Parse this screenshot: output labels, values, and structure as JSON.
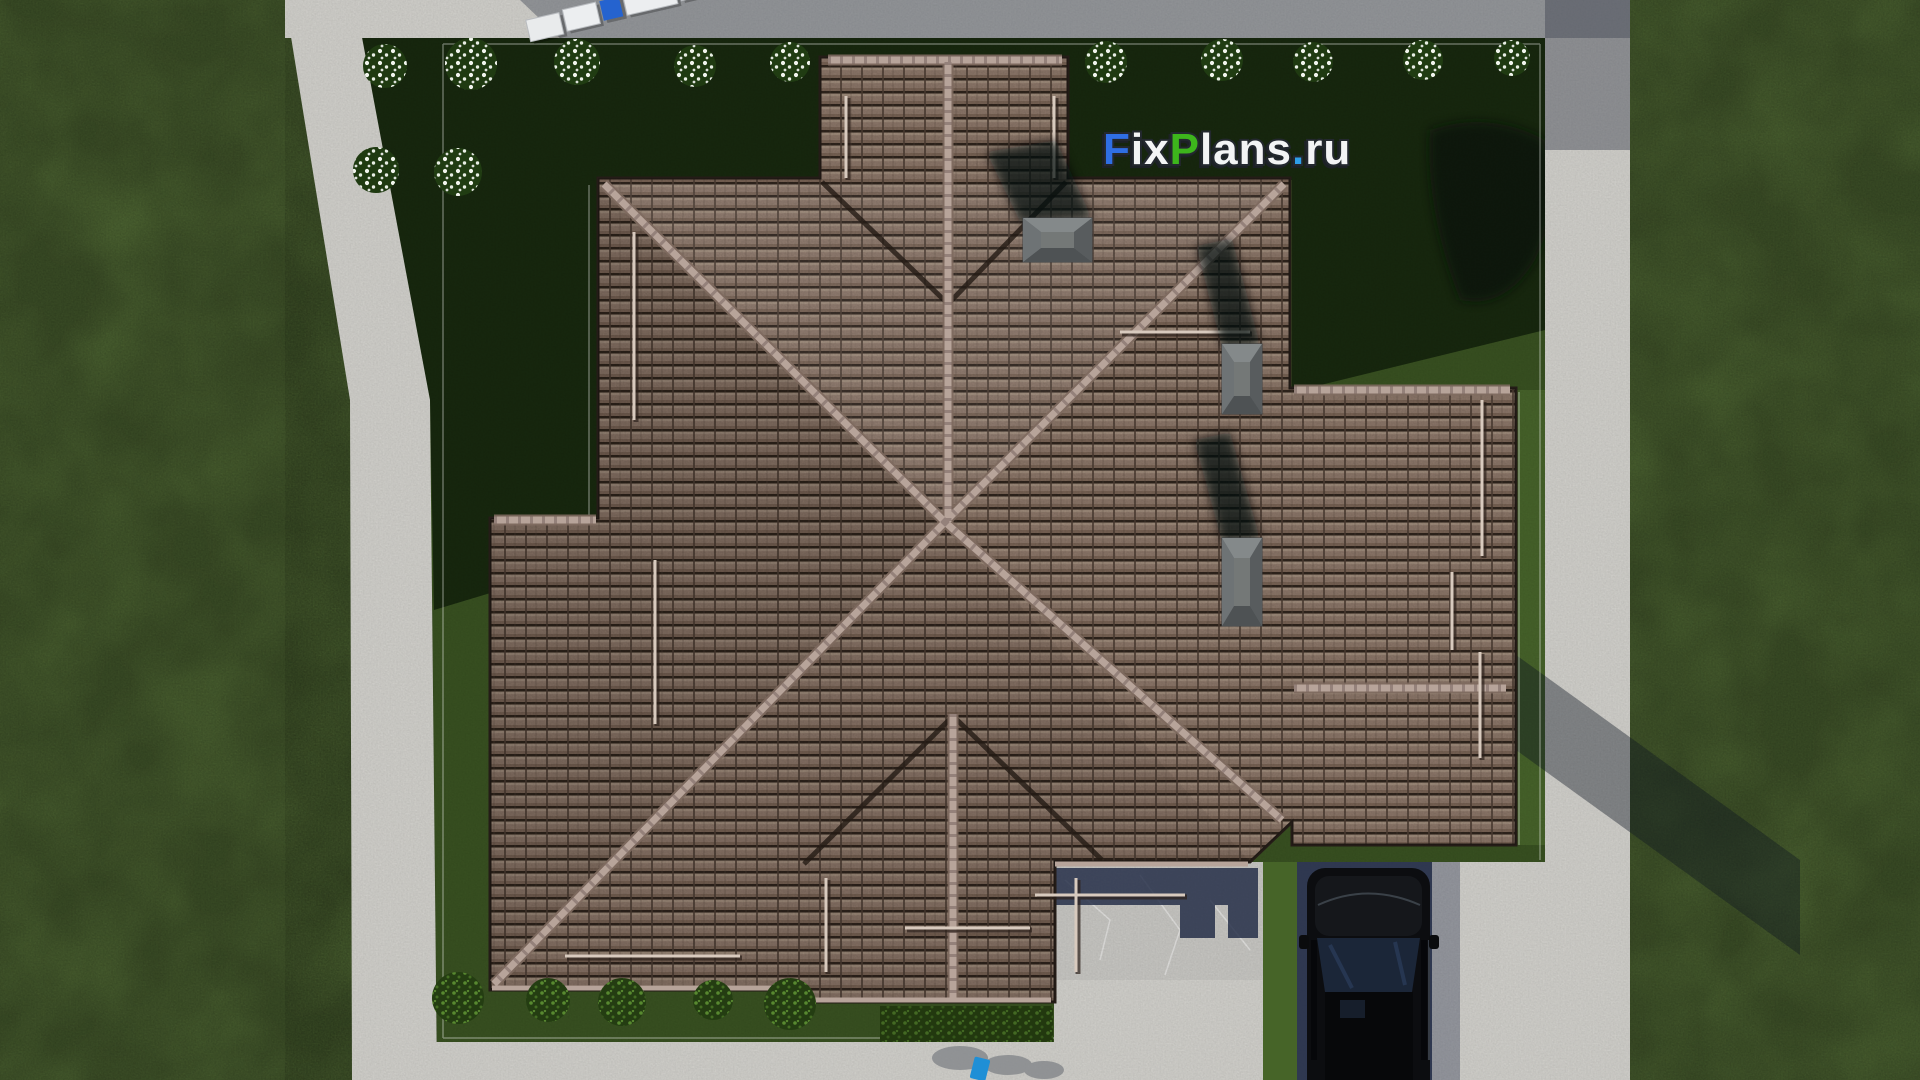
{
  "watermark": {
    "f": "F",
    "ix": "ix",
    "p": "P",
    "lans": "lans",
    "dot": ".",
    "ru": "ru",
    "color_f": "#2f6fe4",
    "color_white": "#f3f4f5",
    "color_p": "#3db51c",
    "color_dot": "#2e9fe8"
  },
  "palette": {
    "grass_outer": "#5c783c",
    "lawn_inner": "#3a5322",
    "lawn_shadow": "#101d0a",
    "concrete": "#d7d6d1",
    "concrete_shadow": "#454b59",
    "marble": "#cdccc8",
    "grass_strip": "#466428",
    "roof_ridge": "#b7a49a",
    "chimney": "#63676a",
    "car_body": "#0c0d10",
    "truck_cab": "#2563cf",
    "shadow_navy": "#222b47"
  }
}
